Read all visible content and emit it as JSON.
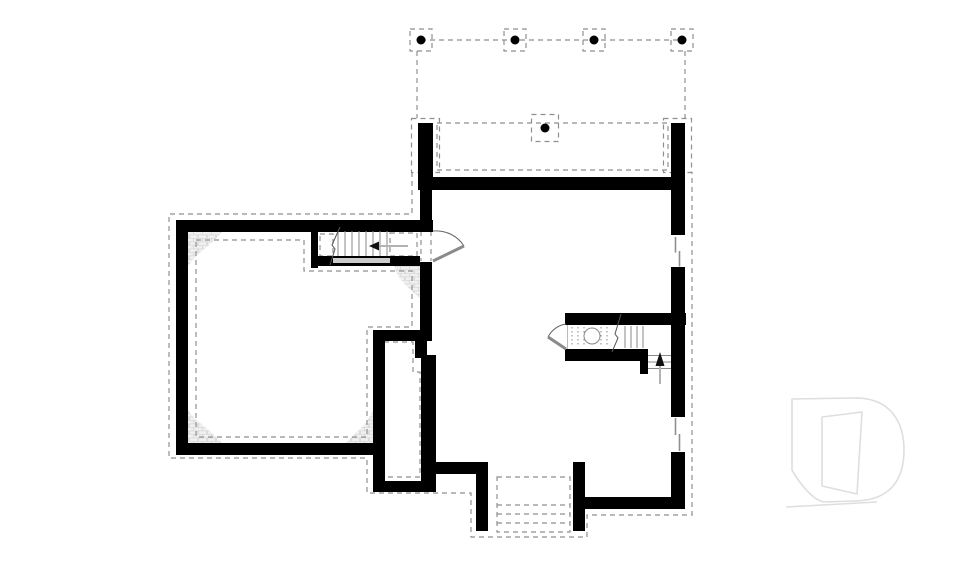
{
  "document": {
    "kind": "basement foundation floor plan",
    "watermark_letter": "D",
    "background": "#ffffff"
  },
  "colors": {
    "wall": "#000000",
    "dash": "#8f8f8f",
    "dash_light": "#a8a8a8",
    "stair_line": "#8a8a8a",
    "break_line": "#555555",
    "stringer": "#cccccc",
    "door_leaf": "#8a8a8a",
    "door_arc": "#666666",
    "arrow_tail": "#b3b3b3",
    "arrow_head": "#111111",
    "window_line": "#8f8f8f",
    "hatch_fill": "#f0f0f0",
    "hatch_line": "#d8d8d8",
    "logo_line": "#dedede",
    "dot": "#000000"
  },
  "inventory": {
    "deck_posts": 4,
    "center_support_post": 1,
    "foundation_piers": 2,
    "windows": 2,
    "doors": 2,
    "stair_runs": 2,
    "exterior_step_flight": 1,
    "corner_pads": 4
  }
}
